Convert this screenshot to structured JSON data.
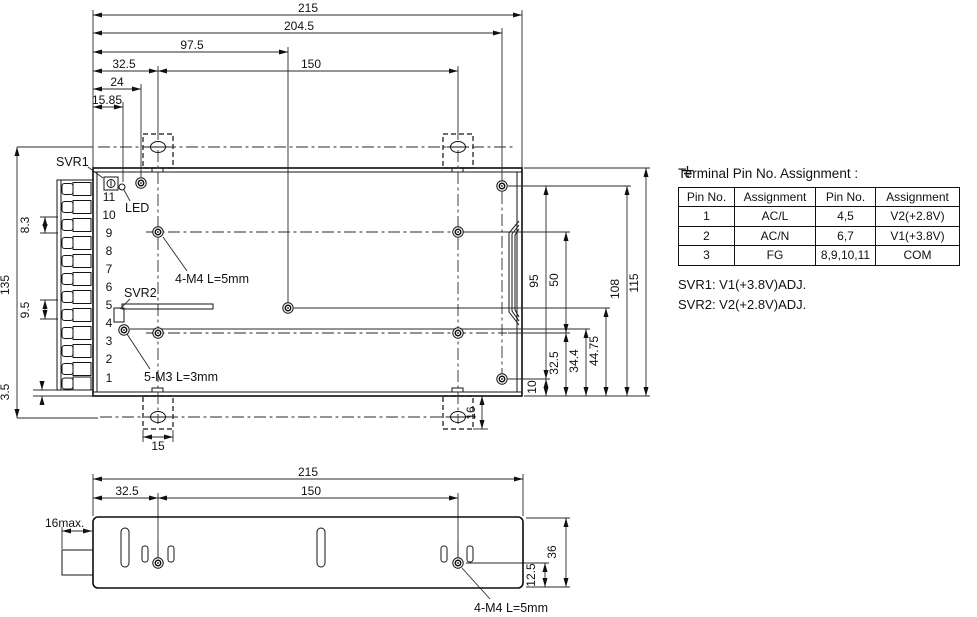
{
  "top_view": {
    "dims": {
      "d215": "215",
      "d204_5": "204.5",
      "d97_5": "97.5",
      "d32_5": "32.5",
      "d150": "150",
      "d24": "24",
      "d15_85": "15.85",
      "d135": "135",
      "d8_3": "8.3",
      "d9_5": "9.5",
      "d3_5": "3.5",
      "d10": "10",
      "d95": "95",
      "d50": "50",
      "d32_5r": "32.5",
      "d34_4": "34.4",
      "d44_75": "44.75",
      "d108": "108",
      "d115": "115",
      "d15": "15",
      "d16": "16"
    },
    "labels": {
      "svr1": "SVR1",
      "led": "LED",
      "svr2": "SVR2",
      "m4": "4-M4 L=5mm",
      "m3": "5-M3 L=3mm"
    },
    "pins": [
      "11",
      "10",
      "9",
      "8",
      "7",
      "6",
      "5",
      "4",
      "3",
      "2",
      "1"
    ]
  },
  "side_view": {
    "dims": {
      "s215": "215",
      "s32_5": "32.5",
      "s150": "150",
      "s16max": "16max.",
      "s36": "36",
      "s12_5": "12.5"
    },
    "labels": {
      "m4": "4-M4 L=5mm"
    }
  },
  "pin_table": {
    "title": "Terminal Pin No. Assignment :",
    "headers": [
      "Pin No.",
      "Assignment",
      "Pin No.",
      "Assignment"
    ],
    "rows": [
      {
        "pin": "1",
        "assign": "AC/L",
        "pin2": "4,5",
        "assign2": "V2(+2.8V)"
      },
      {
        "pin": "2",
        "assign": "AC/N",
        "pin2": "6,7",
        "assign2": "V1(+3.8V)"
      },
      {
        "pin": "3",
        "assign": "FG",
        "pin2": "8,9,10,11",
        "assign2": "COM"
      }
    ],
    "notes": [
      "SVR1: V1(+3.8V)ADJ.",
      "SVR2: V2(+2.8V)ADJ."
    ]
  },
  "colors": {
    "ink": "#111111",
    "background": "#ffffff"
  }
}
